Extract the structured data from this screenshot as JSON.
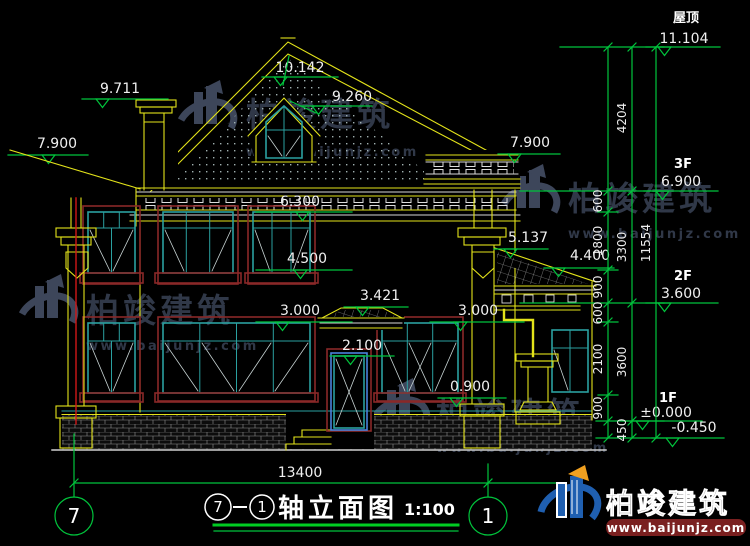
{
  "drawing": {
    "title_axis_start": "7",
    "title_separator": "—",
    "title_axis_end": "1",
    "title_text": "轴立面图",
    "title_scale": "1:100",
    "axis_left": "7",
    "axis_right": "1"
  },
  "levels": {
    "roof_label": "屋顶",
    "roof_value": "11.104",
    "f3_label": "3F",
    "f3_value": "6.900",
    "f2_label": "2F",
    "f2_value": "3.600",
    "f1_label": "1F",
    "f1_value": "±0.000",
    "grade_value": "-0.450"
  },
  "marks": {
    "ridge": "10.142",
    "dormer": "9.260",
    "chimney": "9.711",
    "eave_left": "7.900",
    "eave_right": "7.900",
    "win2_head": "6.300",
    "win2_sill": "4.500",
    "porch_ridge": "5.137",
    "porch_eave": "4.400",
    "win1_head_left": "3.000",
    "win1_head_right": "3.000",
    "canopy": "3.421",
    "door_head": "2.100",
    "win1_sill": "0.900"
  },
  "dims": {
    "seg": [
      "600",
      "1800",
      "900",
      "600",
      "2100",
      "900"
    ],
    "floor": [
      "4204",
      "3300",
      "3600",
      "450"
    ],
    "total_v": "11554",
    "total_h": "13400"
  },
  "watermark": {
    "brand": "柏竣建筑",
    "url": "www.baijunjz.com"
  },
  "footer_logo": {
    "brand": "柏竣建筑",
    "url": "www.baijunjz.com"
  },
  "colors": {
    "line_yellow": "#e3e31a",
    "line_green": "#00c43c",
    "window_teal": "#2aa0a0",
    "surround_maroon": "#8a2828",
    "door_blue": "#4a82dc",
    "downspout_red": "#d01818",
    "logo_blue": "#1f5fb0",
    "logo_orange": "#f0a020",
    "url_bar_red": "#7a2020"
  }
}
